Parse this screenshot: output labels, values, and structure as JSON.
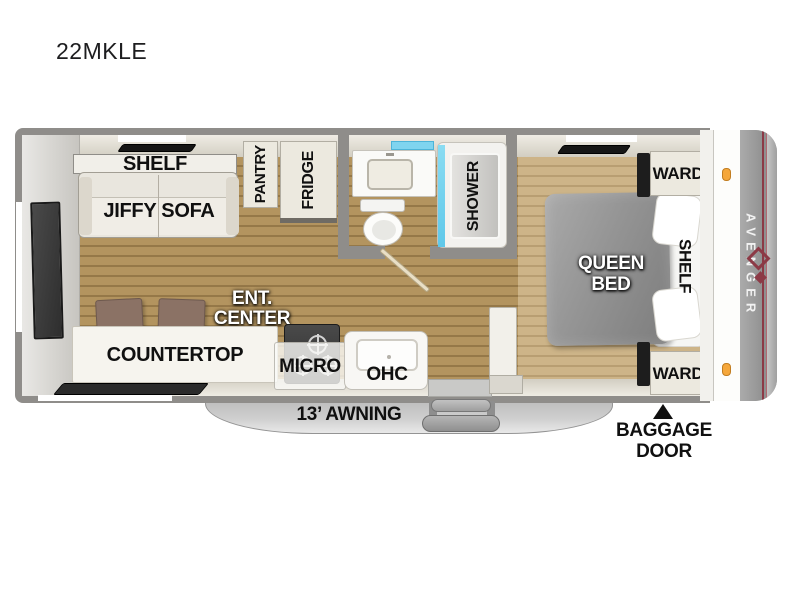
{
  "title": "22MKLE",
  "brand": {
    "name": "AVENGER"
  },
  "living": {
    "shelf_label": "SHELF",
    "sofa_label": "JIFFY SOFA",
    "pantry_label": "PANTRY",
    "fridge_label": "FRIDGE",
    "ent_center_line1": "ENT.",
    "ent_center_line2": "CENTER"
  },
  "kitchen": {
    "countertop_label": "COUNTERTOP",
    "micro_label": "MICRO",
    "ohc_label": "OHC"
  },
  "bath": {
    "shower_label": "SHOWER"
  },
  "bedroom": {
    "queen_line1": "QUEEN",
    "queen_line2": "BED",
    "shelf_label": "SHELF",
    "ward_top_label": "WARD",
    "ward_bottom_label": "WARD"
  },
  "exterior": {
    "awning_label": "13’ AWNING",
    "baggage_line1": "BAGGAGE",
    "baggage_line2": "DOOR"
  },
  "colors": {
    "wall_gray": "#8f8d8a",
    "floor_main": "#b3945f",
    "floor_bedroom": "#cdb488",
    "cabinet_cream": "#ece9df",
    "shower_glass_blue": "#5fc8e9",
    "sink_window_blue": "#7fd4ef",
    "marker_light_orange": "#f5a73b",
    "brand_maroon": "#8c3a46",
    "bed_gray": "#949494",
    "awning_gray": "#cfcfcf"
  }
}
